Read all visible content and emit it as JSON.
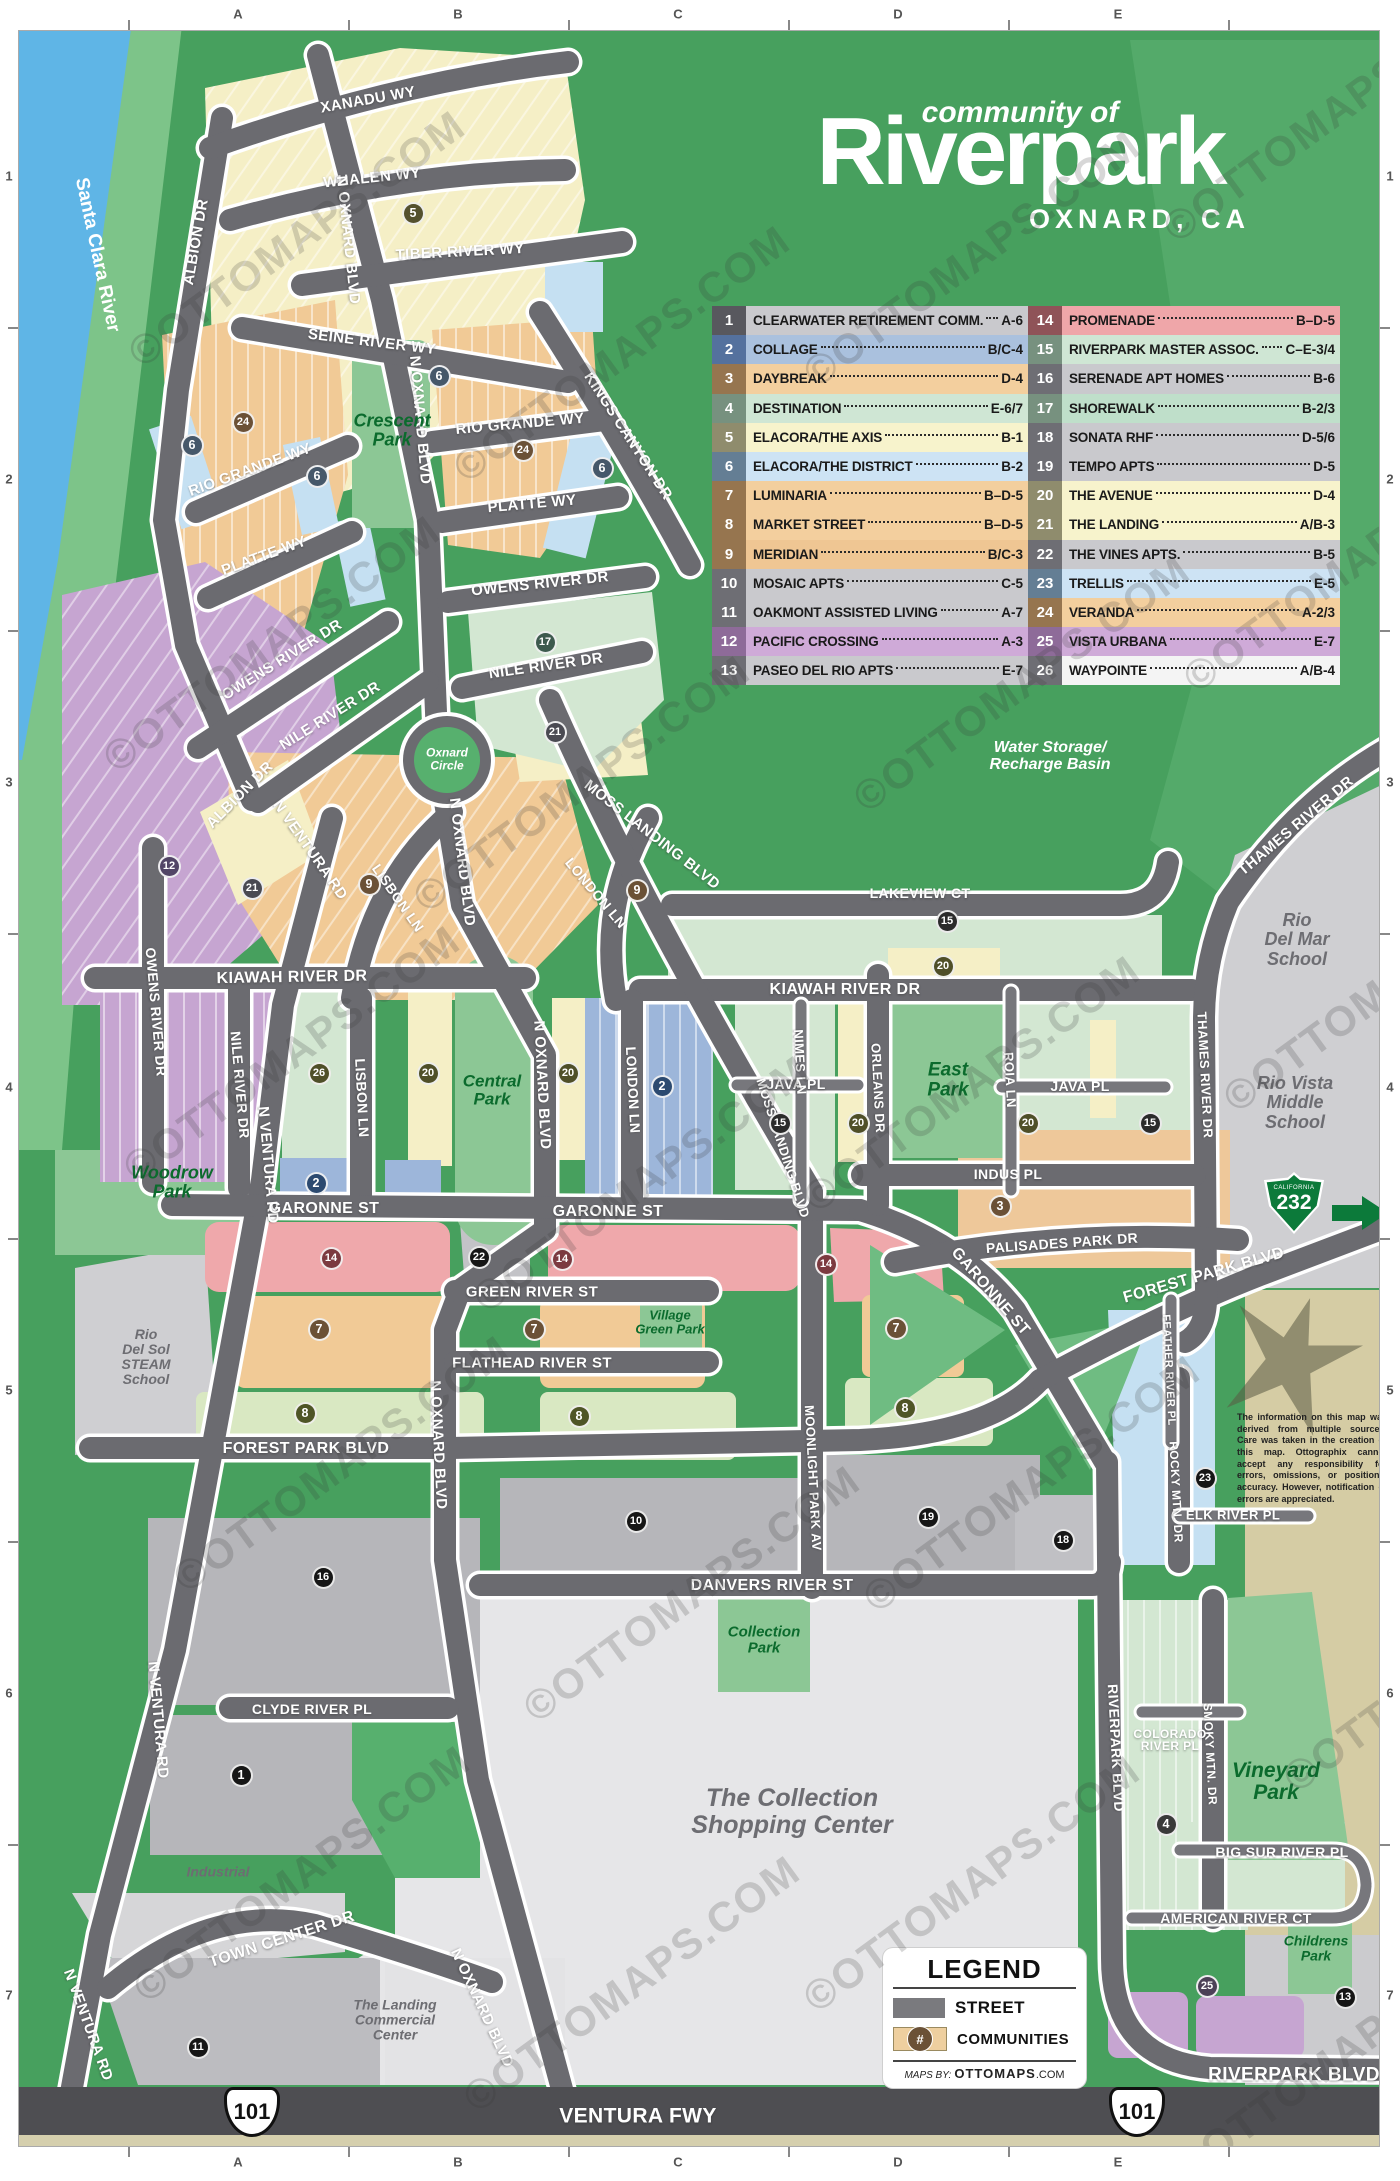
{
  "title": {
    "pre": "community of",
    "main": "Riverpark",
    "sub": "OXNARD, CA"
  },
  "watermark": {
    "text": "©OTTOMAPS.COM",
    "positions": [
      [
        95,
        215
      ],
      [
        70,
        620
      ],
      [
        90,
        1030
      ],
      [
        140,
        1440
      ],
      [
        100,
        1850
      ],
      [
        420,
        330
      ],
      [
        380,
        760
      ],
      [
        440,
        1160
      ],
      [
        490,
        1570
      ],
      [
        430,
        1960
      ],
      [
        770,
        235
      ],
      [
        820,
        660
      ],
      [
        770,
        1060
      ],
      [
        830,
        1460
      ],
      [
        770,
        1860
      ],
      [
        1130,
        90
      ],
      [
        1150,
        540
      ],
      [
        1190,
        960
      ],
      [
        1140,
        2030
      ],
      [
        1250,
        1640
      ]
    ]
  },
  "grid": {
    "cols": [
      "A",
      "B",
      "C",
      "D",
      "E"
    ],
    "rows": [
      "1",
      "2",
      "3",
      "4",
      "5",
      "6",
      "7"
    ]
  },
  "legend_table": {
    "rows": [
      {
        "n": "1",
        "name": "CLEARWATER RETIREMENT COMM.",
        "ref": "A-6",
        "bg": "#c9c9cd",
        "nbg": "#58585e"
      },
      {
        "n": "2",
        "name": "COLLAGE",
        "ref": "B/C-4",
        "bg": "#aac1de",
        "nbg": "#54719e"
      },
      {
        "n": "3",
        "name": "DAYBREAK",
        "ref": "D-4",
        "bg": "#f3cf9e",
        "nbg": "#96754f"
      },
      {
        "n": "4",
        "name": "DESTINATION",
        "ref": "E-6/7",
        "bg": "#cfe6d4",
        "nbg": "#77917f"
      },
      {
        "n": "5",
        "name": "ELACORA/THE AXIS",
        "ref": "B-1",
        "bg": "#f7f3cc",
        "nbg": "#8f8c6d"
      },
      {
        "n": "6",
        "name": "ELACORA/THE DISTRICT",
        "ref": "B-2",
        "bg": "#cde3f4",
        "nbg": "#647e94"
      },
      {
        "n": "7",
        "name": "LUMINARIA",
        "ref": "B–D-5",
        "bg": "#f3cf9e",
        "nbg": "#96754f"
      },
      {
        "n": "8",
        "name": "MARKET STREET",
        "ref": "B–D-5",
        "bg": "#f3cf9e",
        "nbg": "#96754f"
      },
      {
        "n": "9",
        "name": "MERIDIAN",
        "ref": "B/C-3",
        "bg": "#efc693",
        "nbg": "#96754f"
      },
      {
        "n": "10",
        "name": "MOSAIC APTS",
        "ref": "C-5",
        "bg": "#c9c9cd",
        "nbg": "#6e6e74"
      },
      {
        "n": "11",
        "name": "OAKMONT ASSISTED LIVING",
        "ref": "A-7",
        "bg": "#c9c9cd",
        "nbg": "#6e6e74"
      },
      {
        "n": "12",
        "name": "PACIFIC CROSSING",
        "ref": "A-3",
        "bg": "#cfaad8",
        "nbg": "#8e6b99"
      },
      {
        "n": "13",
        "name": "PASEO DEL RIO APTS",
        "ref": "E-7",
        "bg": "#c9c9cd",
        "nbg": "#6e6e74"
      },
      {
        "n": "14",
        "name": "PROMENADE",
        "ref": "B–D-5",
        "bg": "#efa6a9",
        "nbg": "#8f5358"
      },
      {
        "n": "15",
        "name": "RIVERPARK MASTER ASSOC.",
        "ref": "C–E-3/4",
        "bg": "#cfe6d4",
        "nbg": "#77917f"
      },
      {
        "n": "16",
        "name": "SERENADE APT HOMES",
        "ref": "B-6",
        "bg": "#c9c9cd",
        "nbg": "#6e6e74"
      },
      {
        "n": "17",
        "name": "SHOREWALK",
        "ref": "B-2/3",
        "bg": "#bfdfca",
        "nbg": "#77917f"
      },
      {
        "n": "18",
        "name": "SONATA RHF",
        "ref": "D-5/6",
        "bg": "#c9c9cd",
        "nbg": "#6e6e74"
      },
      {
        "n": "19",
        "name": "TEMPO APTS",
        "ref": "D-5",
        "bg": "#c9c9cd",
        "nbg": "#6e6e74"
      },
      {
        "n": "20",
        "name": "THE AVENUE",
        "ref": "D-4",
        "bg": "#f7f3cc",
        "nbg": "#8f8c6d"
      },
      {
        "n": "21",
        "name": "THE LANDING",
        "ref": "A/B-3",
        "bg": "#f7f3cc",
        "nbg": "#8f8c6d"
      },
      {
        "n": "22",
        "name": "THE VINES APTS.",
        "ref": "B-5",
        "bg": "#c9c9cd",
        "nbg": "#6e6e74"
      },
      {
        "n": "23",
        "name": "TRELLIS",
        "ref": "E-5",
        "bg": "#cde3f4",
        "nbg": "#647e94"
      },
      {
        "n": "24",
        "name": "VERANDA",
        "ref": "A-2/3",
        "bg": "#f3cf9e",
        "nbg": "#96754f"
      },
      {
        "n": "25",
        "name": "VISTA URBANA",
        "ref": "E-7",
        "bg": "#cfaad8",
        "nbg": "#8e6b99"
      },
      {
        "n": "26",
        "name": "WAYPOINTE",
        "ref": "A/B-4",
        "bg": "#f4f4f4",
        "nbg": "#6e6e74"
      }
    ]
  },
  "legend_box": {
    "title": "LEGEND",
    "street_label": "STREET",
    "communities_label": "COMMUNITIES",
    "hash_symbol": "#",
    "credit_pre": "MAPS BY:",
    "credit_brand": "OTTOMAPS",
    "credit_tld": ".COM"
  },
  "shields": {
    "us101_label": "101",
    "ca232_label": "232",
    "ca232_state": "CALIFORNIA"
  },
  "map": {
    "disclaimer": "The information on this map was derived from multiple sources. Care was taken in the creation of this map. Ottographix cannot accept any responsibility for errors, omissions, or positional accuracy. However, notification of errors are appreciated.",
    "street_labels": [
      {
        "t": "XANADU WY",
        "x": 368,
        "y": 100,
        "r": -10
      },
      {
        "t": "WHALEN WY",
        "x": 372,
        "y": 178,
        "r": -6
      },
      {
        "t": "TIBER RIVER WY",
        "x": 460,
        "y": 252,
        "r": -3
      },
      {
        "t": "SEINE RIVER WY",
        "x": 372,
        "y": 342,
        "r": 7
      },
      {
        "t": "ALBION DR",
        "x": 196,
        "y": 242,
        "r": -80
      },
      {
        "t": "N OXNARD BLVD",
        "x": 348,
        "y": 240,
        "r": 84
      },
      {
        "t": "KINGS CANYON DR",
        "x": 628,
        "y": 436,
        "r": 57
      },
      {
        "t": "RIO GRANDE WY",
        "x": 250,
        "y": 470,
        "r": -20
      },
      {
        "t": "RIO GRANDE WY",
        "x": 520,
        "y": 424,
        "r": -5
      },
      {
        "t": "PLATTE WY",
        "x": 264,
        "y": 556,
        "r": -20
      },
      {
        "t": "PLATTE WY",
        "x": 532,
        "y": 504,
        "r": -5
      },
      {
        "t": "OWENS RIVER DR",
        "x": 540,
        "y": 584,
        "r": -6
      },
      {
        "t": "OWENS RIVER DR",
        "x": 282,
        "y": 660,
        "r": -32
      },
      {
        "t": "NILE RIVER DR",
        "x": 546,
        "y": 666,
        "r": -8
      },
      {
        "t": "NILE RIVER DR",
        "x": 330,
        "y": 716,
        "r": -32
      },
      {
        "t": "ALBION DR",
        "x": 240,
        "y": 795,
        "r": -45
      },
      {
        "t": "OWENS RIVER DR",
        "x": 156,
        "y": 1012,
        "r": 85,
        "s": 14
      },
      {
        "t": "NILE RIVER DR",
        "x": 240,
        "y": 1085,
        "r": 85,
        "s": 14
      },
      {
        "t": "N OXNARD BLVD",
        "x": 420,
        "y": 420,
        "r": 85
      },
      {
        "t": "N OXNARD BLVD",
        "x": 462,
        "y": 862,
        "r": 83
      },
      {
        "t": "N OXNARD BLVD",
        "x": 542,
        "y": 1085,
        "r": 87
      },
      {
        "t": "N OXNARD BLVD",
        "x": 438,
        "y": 1445,
        "r": 87
      },
      {
        "t": "N OXNARD BLVD",
        "x": 482,
        "y": 2008,
        "r": 65
      },
      {
        "t": "N VENTURA RD",
        "x": 310,
        "y": 850,
        "r": 55
      },
      {
        "t": "N VENTURA RD",
        "x": 268,
        "y": 1165,
        "r": 85
      },
      {
        "t": "N VENTURA RD",
        "x": 158,
        "y": 1720,
        "r": 85
      },
      {
        "t": "N VENTURA RD",
        "x": 88,
        "y": 2025,
        "r": 70
      },
      {
        "t": "LISBON LN",
        "x": 398,
        "y": 898,
        "r": 55,
        "s": 14
      },
      {
        "t": "LISBON LN",
        "x": 362,
        "y": 1098,
        "r": 87,
        "s": 14
      },
      {
        "t": "LONDON LN",
        "x": 596,
        "y": 893,
        "r": 50,
        "s": 14
      },
      {
        "t": "LONDON LN",
        "x": 633,
        "y": 1090,
        "r": 87,
        "s": 14
      },
      {
        "t": "MOSS LANDING BLVD",
        "x": 652,
        "y": 835,
        "r": 38
      },
      {
        "t": "MOSS LANDING BLVD",
        "x": 783,
        "y": 1148,
        "r": 72,
        "s": 13
      },
      {
        "t": "KIAWAH RIVER DR",
        "x": 292,
        "y": 978,
        "r": -1,
        "s": 16
      },
      {
        "t": "KIAWAH RIVER DR",
        "x": 845,
        "y": 990,
        "r": 0,
        "s": 16
      },
      {
        "t": "GARONNE ST",
        "x": 324,
        "y": 1209,
        "r": 0,
        "s": 16
      },
      {
        "t": "GARONNE ST",
        "x": 608,
        "y": 1212,
        "r": 0,
        "s": 16
      },
      {
        "t": "GARONNE ST",
        "x": 990,
        "y": 1292,
        "r": 49,
        "s": 16
      },
      {
        "t": "GREEN RIVER ST",
        "x": 532,
        "y": 1292,
        "r": 0
      },
      {
        "t": "FLATHEAD RIVER ST",
        "x": 532,
        "y": 1363,
        "r": 0
      },
      {
        "t": "FOREST PARK BLVD",
        "x": 306,
        "y": 1449,
        "r": 0,
        "s": 16
      },
      {
        "t": "FOREST PARK BLVD",
        "x": 1204,
        "y": 1276,
        "r": -16,
        "s": 16
      },
      {
        "t": "MOONLIGHT PARK AV",
        "x": 813,
        "y": 1478,
        "r": 87,
        "s": 13
      },
      {
        "t": "PALISADES PARK DR",
        "x": 1062,
        "y": 1243,
        "r": -4,
        "s": 14
      },
      {
        "t": "INDUS PL",
        "x": 1008,
        "y": 1174,
        "r": 0,
        "s": 14
      },
      {
        "t": "JAVA PL",
        "x": 796,
        "y": 1084,
        "r": 0,
        "s": 14
      },
      {
        "t": "JAVA PL",
        "x": 1080,
        "y": 1086,
        "r": 0,
        "s": 14
      },
      {
        "t": "NIMES LN",
        "x": 800,
        "y": 1062,
        "r": 87,
        "s": 13
      },
      {
        "t": "ORLEANS DR",
        "x": 878,
        "y": 1088,
        "r": 87,
        "s": 13
      },
      {
        "t": "ROIA LN",
        "x": 1010,
        "y": 1080,
        "r": 87,
        "s": 13
      },
      {
        "t": "THAMES RIVER DR",
        "x": 1296,
        "y": 826,
        "r": -40
      },
      {
        "t": "THAMES RIVER DR",
        "x": 1205,
        "y": 1075,
        "r": 87,
        "s": 13
      },
      {
        "t": "LAKEVIEW CT",
        "x": 920,
        "y": 893,
        "r": 0,
        "s": 14
      },
      {
        "t": "DANVERS RIVER ST",
        "x": 772,
        "y": 1586,
        "r": 0,
        "s": 16
      },
      {
        "t": "CLYDE RIVER PL",
        "x": 312,
        "y": 1709,
        "r": 0,
        "s": 14
      },
      {
        "t": "TOWN CENTER DR",
        "x": 282,
        "y": 1940,
        "r": -18,
        "s": 16
      },
      {
        "t": "RIVERPARK BLVD",
        "x": 1116,
        "y": 1748,
        "r": 87,
        "s": 14
      },
      {
        "t": "RIVERPARK BLVD",
        "x": 1294,
        "y": 2075,
        "r": 0,
        "s": 19
      },
      {
        "t": "SMOKY MTN. DR",
        "x": 1210,
        "y": 1754,
        "r": 87,
        "s": 12
      },
      {
        "t": "COLORADO\nRIVER PL",
        "x": 1170,
        "y": 1740,
        "r": 0,
        "s": 12
      },
      {
        "t": "BIG SUR RIVER PL",
        "x": 1282,
        "y": 1852,
        "r": 0,
        "s": 14
      },
      {
        "t": "AMERICAN RIVER CT",
        "x": 1236,
        "y": 1918,
        "r": 0,
        "s": 14
      },
      {
        "t": "ELK RIVER PL",
        "x": 1233,
        "y": 1515,
        "r": 0,
        "s": 13
      },
      {
        "t": "ROCKY MTN. DR",
        "x": 1176,
        "y": 1492,
        "r": 87,
        "s": 12
      },
      {
        "t": "FEATHER RIVER PL",
        "x": 1168,
        "y": 1370,
        "r": 87,
        "s": 11
      },
      {
        "t": "VENTURA FWY",
        "x": 638,
        "y": 2116,
        "r": 0,
        "s": 21
      }
    ],
    "park_labels": [
      {
        "t": "Crescent\nPark",
        "x": 392,
        "y": 430,
        "s": 18
      },
      {
        "t": "Central\nPark",
        "x": 492,
        "y": 1090,
        "s": 17
      },
      {
        "t": "East\nPark",
        "x": 948,
        "y": 1080,
        "s": 19
      },
      {
        "t": "Woodrow\nPark",
        "x": 172,
        "y": 1182,
        "s": 18
      },
      {
        "t": "Village\nGreen Park",
        "x": 670,
        "y": 1322,
        "s": 13
      },
      {
        "t": "Collection\nPark",
        "x": 764,
        "y": 1640,
        "s": 15
      },
      {
        "t": "Vineyard\nPark",
        "x": 1276,
        "y": 1782,
        "s": 21
      },
      {
        "t": "Childrens\nPark",
        "x": 1316,
        "y": 1948,
        "s": 14
      }
    ],
    "white_labels": [
      {
        "t": "Water Storage/\nRecharge Basin",
        "x": 1050,
        "y": 757,
        "s": 16,
        "it": true
      },
      {
        "t": "Oxnard\nCircle",
        "x": 447,
        "y": 759,
        "s": 12,
        "it": true
      },
      {
        "t": "Santa Clara River",
        "x": 97,
        "y": 255,
        "s": 19,
        "r": 78,
        "it": false
      }
    ],
    "place_labels": [
      {
        "t": "Rio\nDel Mar\nSchool",
        "x": 1297,
        "y": 940,
        "s": 18
      },
      {
        "t": "Rio Vista\nMiddle\nSchool",
        "x": 1295,
        "y": 1103,
        "s": 18
      },
      {
        "t": "Rio\nDel Sol\nSTEAM\nSchool",
        "x": 146,
        "y": 1357,
        "s": 14
      },
      {
        "t": "The Collection\nShopping Center",
        "x": 792,
        "y": 1812,
        "s": 25
      },
      {
        "t": "Industrial",
        "x": 218,
        "y": 1872,
        "s": 14
      },
      {
        "t": "The Landing\nCommercial\nCenter",
        "x": 395,
        "y": 2020,
        "s": 14
      }
    ],
    "markers": [
      {
        "n": "5",
        "x": 413,
        "y": 213,
        "c": "#54512e"
      },
      {
        "n": "6",
        "x": 439,
        "y": 376,
        "c": "#46586a"
      },
      {
        "n": "6",
        "x": 192,
        "y": 445,
        "c": "#46586a"
      },
      {
        "n": "6",
        "x": 317,
        "y": 476,
        "c": "#46586a"
      },
      {
        "n": "6",
        "x": 602,
        "y": 468,
        "c": "#46586a"
      },
      {
        "n": "24",
        "x": 243,
        "y": 422,
        "c": "#6b5136"
      },
      {
        "n": "24",
        "x": 523,
        "y": 450,
        "c": "#6b5136"
      },
      {
        "n": "17",
        "x": 545,
        "y": 642,
        "c": "#3d5a4e"
      },
      {
        "n": "21",
        "x": 555,
        "y": 732,
        "c": "#4a4a52"
      },
      {
        "n": "21",
        "x": 252,
        "y": 888,
        "c": "#4a4a52"
      },
      {
        "n": "12",
        "x": 169,
        "y": 866,
        "c": "#524566"
      },
      {
        "n": "9",
        "x": 369,
        "y": 884,
        "c": "#6b5136"
      },
      {
        "n": "9",
        "x": 637,
        "y": 890,
        "c": "#6b5136"
      },
      {
        "n": "26",
        "x": 319,
        "y": 1073,
        "c": "#4f4f28"
      },
      {
        "n": "20",
        "x": 428,
        "y": 1073,
        "c": "#4f4f28"
      },
      {
        "n": "20",
        "x": 568,
        "y": 1073,
        "c": "#4f4f28"
      },
      {
        "n": "20",
        "x": 943,
        "y": 966,
        "c": "#4f4f28"
      },
      {
        "n": "20",
        "x": 858,
        "y": 1123,
        "c": "#4f4f28"
      },
      {
        "n": "20",
        "x": 1028,
        "y": 1123,
        "c": "#4f4f28"
      },
      {
        "n": "2",
        "x": 316,
        "y": 1183,
        "c": "#2c4a70"
      },
      {
        "n": "2",
        "x": 662,
        "y": 1086,
        "c": "#2c4a70"
      },
      {
        "n": "15",
        "x": 947,
        "y": 921,
        "c": "#2b2b2b"
      },
      {
        "n": "15",
        "x": 780,
        "y": 1123,
        "c": "#2b2b2b"
      },
      {
        "n": "15",
        "x": 1150,
        "y": 1123,
        "c": "#2b2b2b"
      },
      {
        "n": "22",
        "x": 479,
        "y": 1257,
        "c": "#161616"
      },
      {
        "n": "14",
        "x": 331,
        "y": 1258,
        "c": "#7c3a40"
      },
      {
        "n": "14",
        "x": 562,
        "y": 1259,
        "c": "#7c3a40"
      },
      {
        "n": "14",
        "x": 826,
        "y": 1264,
        "c": "#7c3a40"
      },
      {
        "n": "7",
        "x": 319,
        "y": 1329,
        "c": "#6b5136"
      },
      {
        "n": "7",
        "x": 534,
        "y": 1329,
        "c": "#6b5136"
      },
      {
        "n": "7",
        "x": 896,
        "y": 1328,
        "c": "#6b5136"
      },
      {
        "n": "8",
        "x": 305,
        "y": 1413,
        "c": "#4f5526"
      },
      {
        "n": "8",
        "x": 579,
        "y": 1416,
        "c": "#4f5526"
      },
      {
        "n": "8",
        "x": 905,
        "y": 1408,
        "c": "#4f5526"
      },
      {
        "n": "3",
        "x": 1000,
        "y": 1206,
        "c": "#6b5136"
      },
      {
        "n": "10",
        "x": 636,
        "y": 1521,
        "c": "#161616"
      },
      {
        "n": "19",
        "x": 928,
        "y": 1517,
        "c": "#161616"
      },
      {
        "n": "18",
        "x": 1063,
        "y": 1540,
        "c": "#161616"
      },
      {
        "n": "23",
        "x": 1205,
        "y": 1478,
        "c": "#161616"
      },
      {
        "n": "16",
        "x": 323,
        "y": 1577,
        "c": "#161616"
      },
      {
        "n": "1",
        "x": 241,
        "y": 1775,
        "c": "#161616"
      },
      {
        "n": "11",
        "x": 198,
        "y": 2047,
        "c": "#161616"
      },
      {
        "n": "4",
        "x": 1166,
        "y": 1824,
        "c": "#3a3a3a"
      },
      {
        "n": "25",
        "x": 1207,
        "y": 1986,
        "c": "#4c4157"
      },
      {
        "n": "13",
        "x": 1345,
        "y": 1997,
        "c": "#161616"
      }
    ]
  }
}
